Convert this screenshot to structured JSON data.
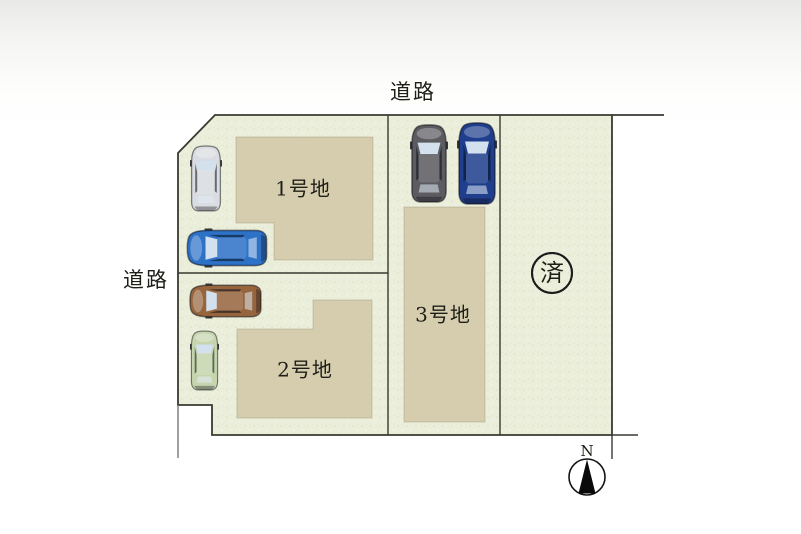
{
  "plan": {
    "road_label_top": "道路",
    "road_label_left": "道路",
    "lots": [
      {
        "label": "1号地"
      },
      {
        "label": "2号地"
      },
      {
        "label": "3号地"
      }
    ],
    "sold_mark": "済",
    "compass": {
      "north_label": "N"
    },
    "colors": {
      "site_fill": "#eaeeda",
      "site_speckle": "#dce4c4",
      "building_fill": "#d5cdae",
      "outline": "#3a3a32"
    },
    "cars": [
      {
        "name": "silver-car",
        "color": "#d9dce0"
      },
      {
        "name": "blue-car",
        "color": "#2e72c8"
      },
      {
        "name": "brown-car",
        "color": "#96653e"
      },
      {
        "name": "green-car",
        "color": "#c6d5ae"
      },
      {
        "name": "dark-gray-car",
        "color": "#5b5b60"
      },
      {
        "name": "navy-car",
        "color": "#1f3e8c"
      }
    ]
  }
}
